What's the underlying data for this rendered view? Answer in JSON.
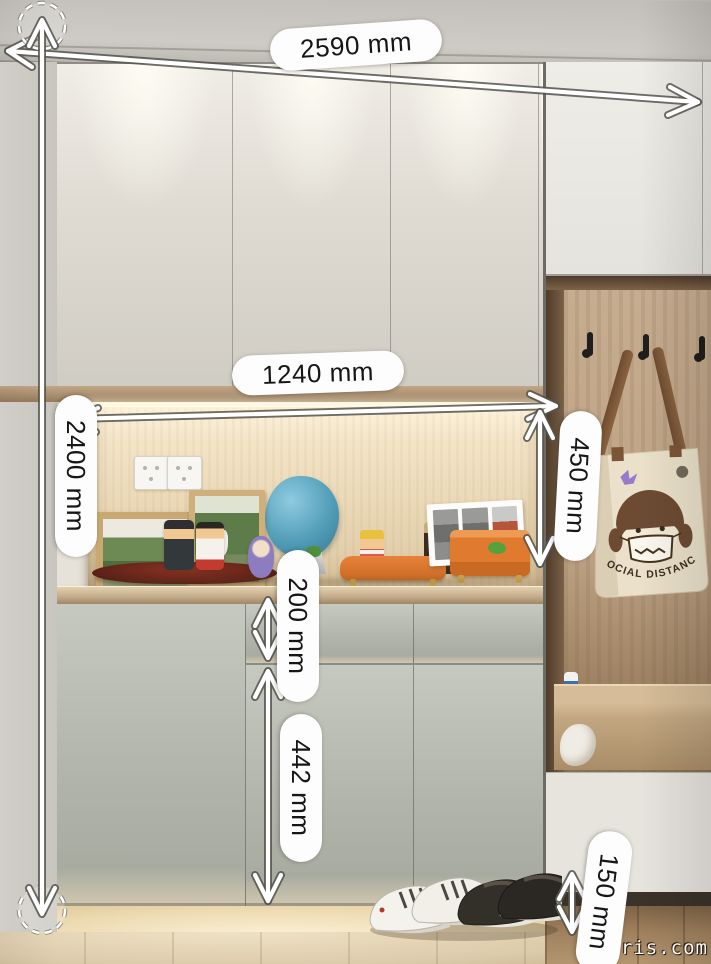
{
  "scene": {
    "description": "Hallway shoe cabinet photo with LED-lit display niche, open coat section with tote bag, sneakers on floor, annotated with millimetre dimensions",
    "watermark": "-paris.com"
  },
  "annotations": {
    "unit": "mm",
    "labels": {
      "total_width": "2590 mm",
      "total_height": "2400 mm",
      "niche_width": "1240 mm",
      "niche_height": "450 mm",
      "drawer_front": "200 mm",
      "door_front": "442 mm",
      "toe_kick": "150 mm"
    },
    "values": {
      "total_width_mm": 2590,
      "total_height_mm": 2400,
      "niche_width_mm": 1240,
      "niche_height_mm": 450,
      "drawer_front_mm": 200,
      "door_front_mm": 442,
      "toe_kick_mm": 150
    }
  },
  "tote_bag": {
    "print_text": "SOCIAL DISTANCE"
  },
  "colors": {
    "upper_door": "#ddd9d2",
    "lower_door": "#b4b7ad",
    "niche_wood": "#ecdcbe",
    "trim_wood": "#a98e6d",
    "open_area_wood": "#c1a689",
    "label_pill": "#fdfdfd",
    "label_text": "#161616",
    "arrow": "#ffffff"
  }
}
